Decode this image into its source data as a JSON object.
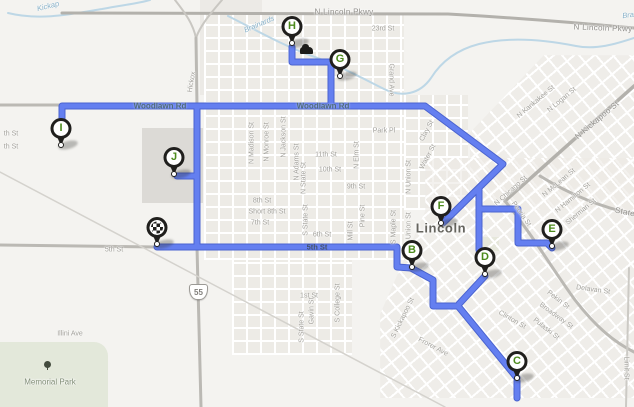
{
  "map": {
    "city": "Lincoln",
    "highway_shield": "55",
    "colors": {
      "route_core": "#647ff0",
      "route_casing": "#4a63cf",
      "water": "#bdd7e6",
      "marker_letter": "#4c8a1c",
      "land": "#f4f3f0"
    }
  },
  "markers": [
    {
      "id": "depot",
      "type": "depot",
      "letter": "",
      "x": 157,
      "y": 247
    },
    {
      "id": "I",
      "type": "stop",
      "letter": "I",
      "x": 61,
      "y": 148
    },
    {
      "id": "J",
      "type": "stop",
      "letter": "J",
      "x": 174,
      "y": 177
    },
    {
      "id": "H",
      "type": "stop",
      "letter": "H",
      "x": 292,
      "y": 46
    },
    {
      "id": "G",
      "type": "stop",
      "letter": "G",
      "x": 340,
      "y": 79
    },
    {
      "id": "F",
      "type": "stop",
      "letter": "F",
      "x": 441,
      "y": 226
    },
    {
      "id": "B",
      "type": "stop",
      "letter": "B",
      "x": 412,
      "y": 270
    },
    {
      "id": "D",
      "type": "stop",
      "letter": "D",
      "x": 485,
      "y": 277
    },
    {
      "id": "E",
      "type": "stop",
      "letter": "E",
      "x": 552,
      "y": 249
    },
    {
      "id": "C",
      "type": "stop",
      "letter": "C",
      "x": 517,
      "y": 381
    }
  ],
  "street_labels": [
    {
      "id": "n-lincoln-pkwy-w",
      "text": "N Lincoln Pkwy",
      "x": 344,
      "y": 12,
      "rot": 0,
      "kind": "road-major"
    },
    {
      "id": "n-lincoln-pkwy-e",
      "text": "N Lincoln Pkwy",
      "x": 603,
      "y": 28,
      "rot": 2,
      "kind": "road-major"
    },
    {
      "id": "twentythird-st",
      "text": "23rd St",
      "x": 383,
      "y": 29,
      "rot": 0,
      "kind": "minor"
    },
    {
      "id": "kickapoo-creek",
      "text": "Kickap",
      "x": 48,
      "y": 6,
      "rot": -14,
      "kind": "water"
    },
    {
      "id": "brainards",
      "text": "Brainards",
      "x": 259,
      "y": 24,
      "rot": -23,
      "kind": "water"
    },
    {
      "id": "bra-ne",
      "text": "Bra",
      "x": 628,
      "y": 15,
      "rot": -8,
      "kind": "water"
    },
    {
      "id": "hickox",
      "text": "Hickox",
      "x": 192,
      "y": 82,
      "rot": -80,
      "kind": "minor"
    },
    {
      "id": "woodlawn-rd-w",
      "text": "Woodlawn Rd",
      "x": 160,
      "y": 106,
      "rot": 0,
      "kind": "on-route"
    },
    {
      "id": "woodlawn-rd-e",
      "text": "Woodlawn Rd",
      "x": 323,
      "y": 106,
      "rot": 0,
      "kind": "on-route"
    },
    {
      "id": "grand-ave",
      "text": "Grand Ave",
      "x": 391,
      "y": 80,
      "rot": 90,
      "kind": "minor"
    },
    {
      "id": "park-pl",
      "text": "Park Pl",
      "x": 384,
      "y": 131,
      "rot": 0,
      "kind": "minor"
    },
    {
      "id": "clay-st",
      "text": "Clay St",
      "x": 427,
      "y": 131,
      "rot": -62,
      "kind": "minor"
    },
    {
      "id": "water-st",
      "text": "Water St",
      "x": 428,
      "y": 157,
      "rot": -62,
      "kind": "minor"
    },
    {
      "id": "n-union-st",
      "text": "N Union St",
      "x": 409,
      "y": 177,
      "rot": -90,
      "kind": "minor"
    },
    {
      "id": "n-elm-st",
      "text": "N Elm St",
      "x": 357,
      "y": 155,
      "rot": -90,
      "kind": "minor"
    },
    {
      "id": "eleventh-st",
      "text": "11th St",
      "x": 326,
      "y": 155,
      "rot": 0,
      "kind": "minor"
    },
    {
      "id": "tenth-st",
      "text": "10th St",
      "x": 330,
      "y": 170,
      "rot": 0,
      "kind": "minor"
    },
    {
      "id": "ninth-st",
      "text": "9th St",
      "x": 356,
      "y": 187,
      "rot": 0,
      "kind": "minor"
    },
    {
      "id": "eighth-st",
      "text": "8th St",
      "x": 262,
      "y": 201,
      "rot": 0,
      "kind": "minor"
    },
    {
      "id": "short-eighth-st",
      "text": "Short 8th St",
      "x": 267,
      "y": 212,
      "rot": 0,
      "kind": "minor"
    },
    {
      "id": "seventh-st",
      "text": "7th St",
      "x": 260,
      "y": 223,
      "rot": 0,
      "kind": "minor"
    },
    {
      "id": "sixth-st",
      "text": "6th St",
      "x": 322,
      "y": 235,
      "rot": 0,
      "kind": "minor"
    },
    {
      "id": "fifth-st-mid",
      "text": "5th St",
      "x": 317,
      "y": 247,
      "rot": 0,
      "kind": "on-route-dark"
    },
    {
      "id": "fifth-st-w",
      "text": "5th St",
      "x": 114,
      "y": 250,
      "rot": 0,
      "kind": "minor"
    },
    {
      "id": "n-madison-st",
      "text": "N Madison St",
      "x": 252,
      "y": 143,
      "rot": -90,
      "kind": "minor"
    },
    {
      "id": "n-monroe-st",
      "text": "N Monroe St",
      "x": 267,
      "y": 142,
      "rot": -90,
      "kind": "minor"
    },
    {
      "id": "n-jackson-st",
      "text": "N Jackson St",
      "x": 284,
      "y": 137,
      "rot": -90,
      "kind": "minor"
    },
    {
      "id": "n-adams-st",
      "text": "N Adams St",
      "x": 297,
      "y": 162,
      "rot": -90,
      "kind": "minor"
    },
    {
      "id": "n-state-st",
      "text": "N State St",
      "x": 304,
      "y": 178,
      "rot": -90,
      "kind": "minor"
    },
    {
      "id": "s-state-st-n",
      "text": "S State St",
      "x": 306,
      "y": 220,
      "rot": -90,
      "kind": "minor"
    },
    {
      "id": "s-state-st-s",
      "text": "S State St",
      "x": 302,
      "y": 327,
      "rot": -90,
      "kind": "minor"
    },
    {
      "id": "gavin-st",
      "text": "Gavin St",
      "x": 312,
      "y": 311,
      "rot": -90,
      "kind": "minor"
    },
    {
      "id": "first-st",
      "text": "1st St",
      "x": 309,
      "y": 296,
      "rot": 0,
      "kind": "minor"
    },
    {
      "id": "s-college-st",
      "text": "S College St",
      "x": 338,
      "y": 303,
      "rot": -90,
      "kind": "minor"
    },
    {
      "id": "pine-st",
      "text": "Pine St",
      "x": 363,
      "y": 216,
      "rot": -90,
      "kind": "minor"
    },
    {
      "id": "mill-st",
      "text": "Mill St",
      "x": 351,
      "y": 231,
      "rot": -90,
      "kind": "minor"
    },
    {
      "id": "s-maple-st",
      "text": "S Maple St",
      "x": 394,
      "y": 227,
      "rot": -90,
      "kind": "minor"
    },
    {
      "id": "s-union-st",
      "text": "S Union St",
      "x": 409,
      "y": 229,
      "rot": -90,
      "kind": "minor"
    },
    {
      "id": "s-kickapoo-st",
      "text": "S Kickapoo St",
      "x": 403,
      "y": 318,
      "rot": -64,
      "kind": "minor"
    },
    {
      "id": "frorer-ave",
      "text": "Frorer Ave",
      "x": 433,
      "y": 347,
      "rot": 28,
      "kind": "minor"
    },
    {
      "id": "n-kankakee-st",
      "text": "N Kankakee St",
      "x": 536,
      "y": 102,
      "rot": -40,
      "kind": "minor"
    },
    {
      "id": "n-logan-st",
      "text": "N Logan St",
      "x": 562,
      "y": 100,
      "rot": -40,
      "kind": "minor"
    },
    {
      "id": "n-kickapoo-st",
      "text": "N Kickapoo St",
      "x": 597,
      "y": 120,
      "rot": -40,
      "kind": "road-major"
    },
    {
      "id": "n-chicago-st",
      "text": "N Chicago St",
      "x": 511,
      "y": 191,
      "rot": -42,
      "kind": "minor"
    },
    {
      "id": "peoria-st",
      "text": "Peoria St",
      "x": 521,
      "y": 214,
      "rot": 55,
      "kind": "minor"
    },
    {
      "id": "n-mclean-st",
      "text": "N McLean St",
      "x": 559,
      "y": 183,
      "rot": -40,
      "kind": "minor"
    },
    {
      "id": "n-hamilton-st",
      "text": "N Hamilton St",
      "x": 573,
      "y": 198,
      "rot": -40,
      "kind": "minor"
    },
    {
      "id": "sherman-st",
      "text": "Sherman St",
      "x": 581,
      "y": 212,
      "rot": -40,
      "kind": "minor"
    },
    {
      "id": "state-rd",
      "text": "State",
      "x": 625,
      "y": 212,
      "rot": 12,
      "kind": "road-major"
    },
    {
      "id": "delavan-st",
      "text": "Delavan St",
      "x": 593,
      "y": 290,
      "rot": 8,
      "kind": "minor"
    },
    {
      "id": "pekin-st",
      "text": "Pekin St",
      "x": 558,
      "y": 300,
      "rot": 38,
      "kind": "minor"
    },
    {
      "id": "broadway-st",
      "text": "Broadway St",
      "x": 556,
      "y": 316,
      "rot": 36,
      "kind": "minor"
    },
    {
      "id": "pulaski-st",
      "text": "Pulaski St",
      "x": 546,
      "y": 329,
      "rot": 38,
      "kind": "minor"
    },
    {
      "id": "clinton-st",
      "text": "Clinton St",
      "x": 512,
      "y": 320,
      "rot": 30,
      "kind": "minor"
    },
    {
      "id": "limit-st",
      "text": "Limit St",
      "x": 626,
      "y": 368,
      "rot": 90,
      "kind": "minor"
    },
    {
      "id": "lincoln-city",
      "text": "Lincoln",
      "x": 441,
      "y": 228,
      "rot": 0,
      "kind": "city"
    },
    {
      "id": "illini-ave",
      "text": "Illini Ave",
      "x": 70,
      "y": 334,
      "rot": 0,
      "kind": "minor"
    },
    {
      "id": "memorial-park",
      "text": "Memorial Park",
      "x": 50,
      "y": 382,
      "rot": 0,
      "kind": "park"
    },
    {
      "id": "cut-th-st-1",
      "text": "th St",
      "x": 11,
      "y": 134,
      "rot": 0,
      "kind": "minor"
    },
    {
      "id": "cut-th-st-2",
      "text": "th St",
      "x": 11,
      "y": 147,
      "rot": 0,
      "kind": "minor"
    }
  ],
  "route": {
    "paths": [
      "M62 124 L62 106 L425 106 L503 164 L443 223",
      "M197 106 L197 247",
      "M197 176 L177 176",
      "M157 247 L397 247 L397 267 L411 268",
      "M292 47 L292 62 L331 62 L331 106",
      "M479 189 L479 209 L518 209 L518 243 L547 243 L552 248",
      "M479 209 L479 250",
      "M485 276 L459 304",
      "M411 268 L433 280 L433 306 L458 306 L517 378",
      "M517 381 L517 398"
    ]
  },
  "roads": [
    {
      "d": "M62 13 L448 14 C520 18 580 23 634 28",
      "w": 3,
      "c": "#b3b1ac"
    },
    {
      "d": "M175 0 C186 14 193 24 196 38",
      "w": 2,
      "c": "#c9c7c2"
    },
    {
      "d": "M222 0 C210 14 200 26 196 38",
      "w": 2,
      "c": "#c9c7c2"
    },
    {
      "d": "M196 38 L197 106 L197 247 L201 407",
      "w": 3,
      "c": "#bbb9b4"
    },
    {
      "d": "M0 105 L62 105",
      "w": 3,
      "c": "#bbb9b4"
    },
    {
      "d": "M0 245 L157 247",
      "w": 3,
      "c": "#bbb9b4"
    },
    {
      "d": "M0 172 L445 407",
      "w": 1.5,
      "c": "#d4d2cd"
    },
    {
      "d": "M634 86 L505 201",
      "w": 3.5,
      "c": "#b3b1ac"
    },
    {
      "d": "M505 201 C532 234 553 270 575 300 C596 327 614 342 634 352",
      "w": 3,
      "c": "#bbb9b4"
    },
    {
      "d": "M540 176 C574 197 604 208 634 214",
      "w": 3,
      "c": "#b9b7b2"
    },
    {
      "d": "M629 268 L626 407",
      "w": 2,
      "c": "#cccac5"
    }
  ],
  "streams": [
    {
      "d": "M8 13 C40 21 72 14 102 9 C122 5 136 4 150 0"
    },
    {
      "d": "M228 16 C258 31 282 45 312 56 C338 65 358 76 384 89 C402 98 420 94 431 78 C441 62 456 50 479 44 C511 36 546 40 576 46 C596 50 616 44 634 38"
    }
  ]
}
